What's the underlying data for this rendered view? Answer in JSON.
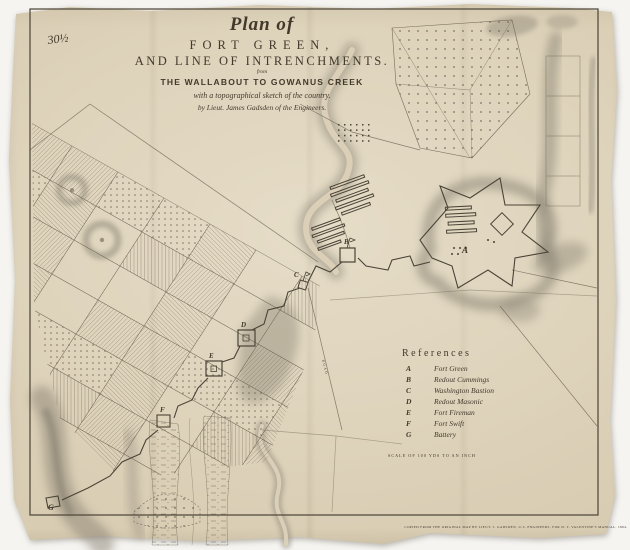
{
  "colors": {
    "background": "#f5f4f1",
    "paper": "#d8ccb2",
    "ink": "#42392b",
    "shade": "#8f8878",
    "faint_ink": "#6d6454"
  },
  "title": {
    "line1": "Plan of",
    "line2": "FORT GREEN,",
    "line3": "AND LINE OF INTRENCHMENTS.",
    "line4": "from",
    "line5": "THE WALLABOUT TO GOWANUS CREEK",
    "line6": "with a topographical sketch of the country.",
    "line7": "by Lieut. James Gadsden of the Engineers."
  },
  "references": {
    "heading": "References",
    "items": [
      {
        "letter": "A",
        "name": "Fort Green"
      },
      {
        "letter": "B",
        "name": "Redout Cummings"
      },
      {
        "letter": "C",
        "name": "Washington Bastion"
      },
      {
        "letter": "D",
        "name": "Redout Masonic"
      },
      {
        "letter": "E",
        "name": "Fort Fireman"
      },
      {
        "letter": "F",
        "name": "Fort Swift"
      },
      {
        "letter": "G",
        "name": "Battery"
      }
    ]
  },
  "scale_note": "SCALE OF 100 YDS TO AN INCH",
  "imprint": "COPIED FROM THE ORIGINAL MAP BY LIEUT. J. GADSDEN, U.S. ENGINEERS, FOR D. T. VALENTINE'S MANUAL, 1864.",
  "road_label": "ROAD",
  "pencil_note": "30½"
}
